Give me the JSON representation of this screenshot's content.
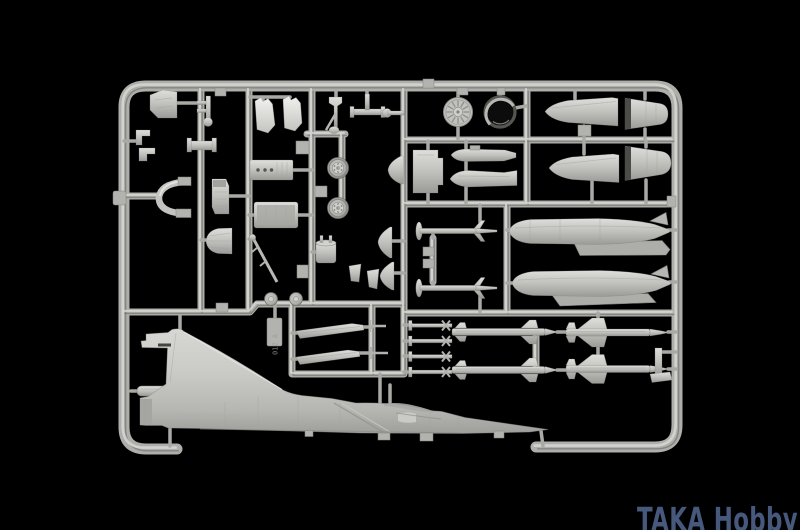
{
  "watermark": {
    "text": "TAKA Hobby",
    "color": "#46597d"
  },
  "sprue_plate_label": "012 A",
  "colors": {
    "background": "#000000",
    "plastic": "#b4b5b1",
    "plastic-light": "#d6d7d3",
    "plastic-dark": "#8b8c88",
    "ring-interior": "#0c0c0c",
    "watermark": "#46597d"
  },
  "parts": [
    "fuselage-half-with-tail-fin",
    "tail-boom",
    "engine-fan-disc",
    "engine-nozzle-ring",
    "radome-cone-1",
    "radome-cone-2",
    "exhaust-nozzle-1",
    "exhaust-nozzle-2",
    "drop-tank-1",
    "drop-tank-2",
    "tank-pylon-1",
    "tank-pylon-2",
    "main-wheel-1",
    "main-wheel-2",
    "nose-wheel-1",
    "nose-wheel-2",
    "ejection-seat",
    "instrument-panel",
    "cockpit-tub",
    "canopy-frame",
    "windscreen-blade-1",
    "windscreen-blade-2",
    "nose-gear-strut",
    "gear-door-shell",
    "boarding-ladder",
    "exhaust-pipe",
    "equipment-box",
    "pod-half-1",
    "pod-half-2",
    "magic-missile-1",
    "magic-missile-2",
    "missile-rod-1",
    "missile-rod-2",
    "missile-rod-3",
    "missile-rod-4",
    "mid-missile-1",
    "mid-missile-2",
    "super530-missile-1",
    "super530-missile-2",
    "pylon-rail-1",
    "pylon-rail-2",
    "wing-pylon-bracket",
    "sprue-letter-plate"
  ]
}
